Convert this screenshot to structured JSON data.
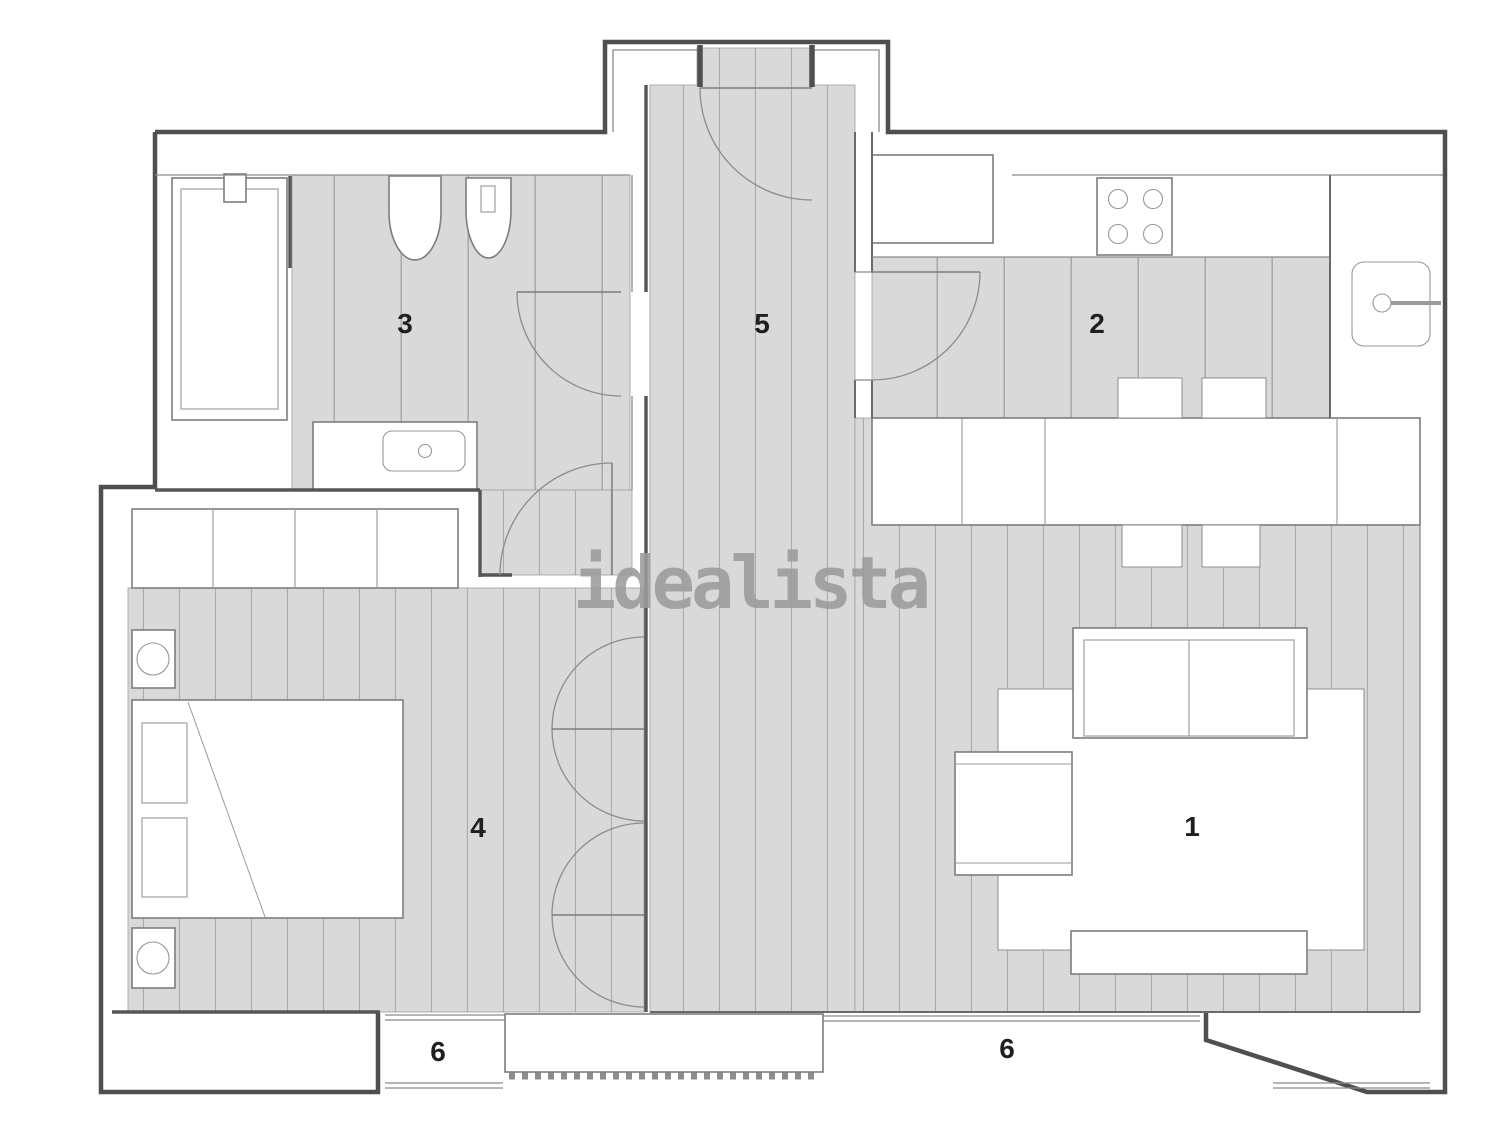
{
  "watermark": "idealista",
  "rooms": [
    {
      "name": "living-room",
      "label": "1"
    },
    {
      "name": "kitchen",
      "label": "2"
    },
    {
      "name": "bathroom",
      "label": "3"
    },
    {
      "name": "bedroom",
      "label": "4"
    },
    {
      "name": "hall",
      "label": "5"
    },
    {
      "name": "terrace-left",
      "label": "6"
    },
    {
      "name": "terrace-right",
      "label": "6"
    }
  ],
  "colors": {
    "background": "#ffffff",
    "floor_fill": "#d9d9d9",
    "floor_stripe": "#ababab",
    "wall": "#4f4f4f",
    "furniture_stroke": "#7d7d7d",
    "label": "#1f1f1f",
    "watermark": "#9b9b9b"
  }
}
